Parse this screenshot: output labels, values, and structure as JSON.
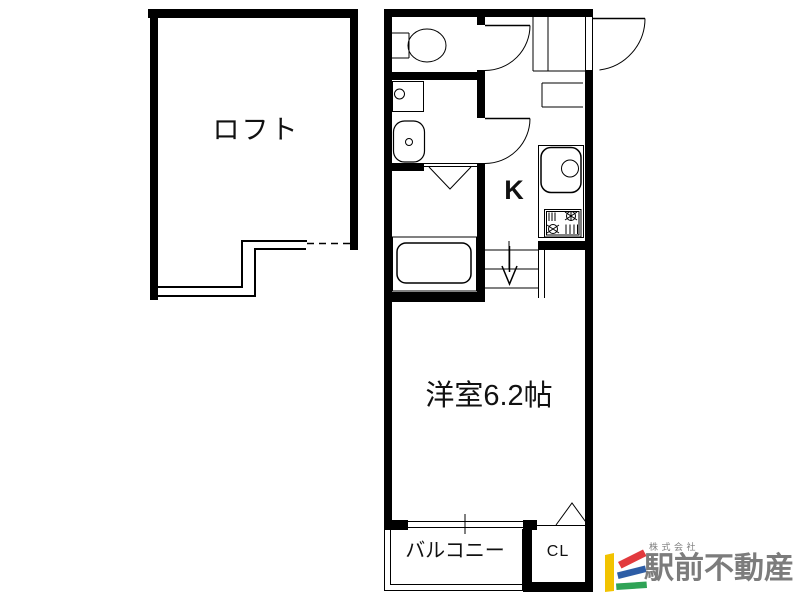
{
  "floorplan": {
    "rooms": {
      "loft": "ロフト",
      "kitchen": "K",
      "western_room": "洋室6.2帖",
      "balcony": "バルコニー",
      "closet": "CL"
    }
  },
  "branding": {
    "company_prefix": "株式会社",
    "company_name": "駅前不動産",
    "colors": {
      "bar_yellow": "#F2C300",
      "bar_red": "#E23A3E",
      "bar_blue": "#2D5DA6",
      "bar_green": "#2FA356",
      "text_gray": "#7C7C7C"
    }
  },
  "drawing": {
    "wall_color": "#000000",
    "background": "#FFFFFF"
  }
}
